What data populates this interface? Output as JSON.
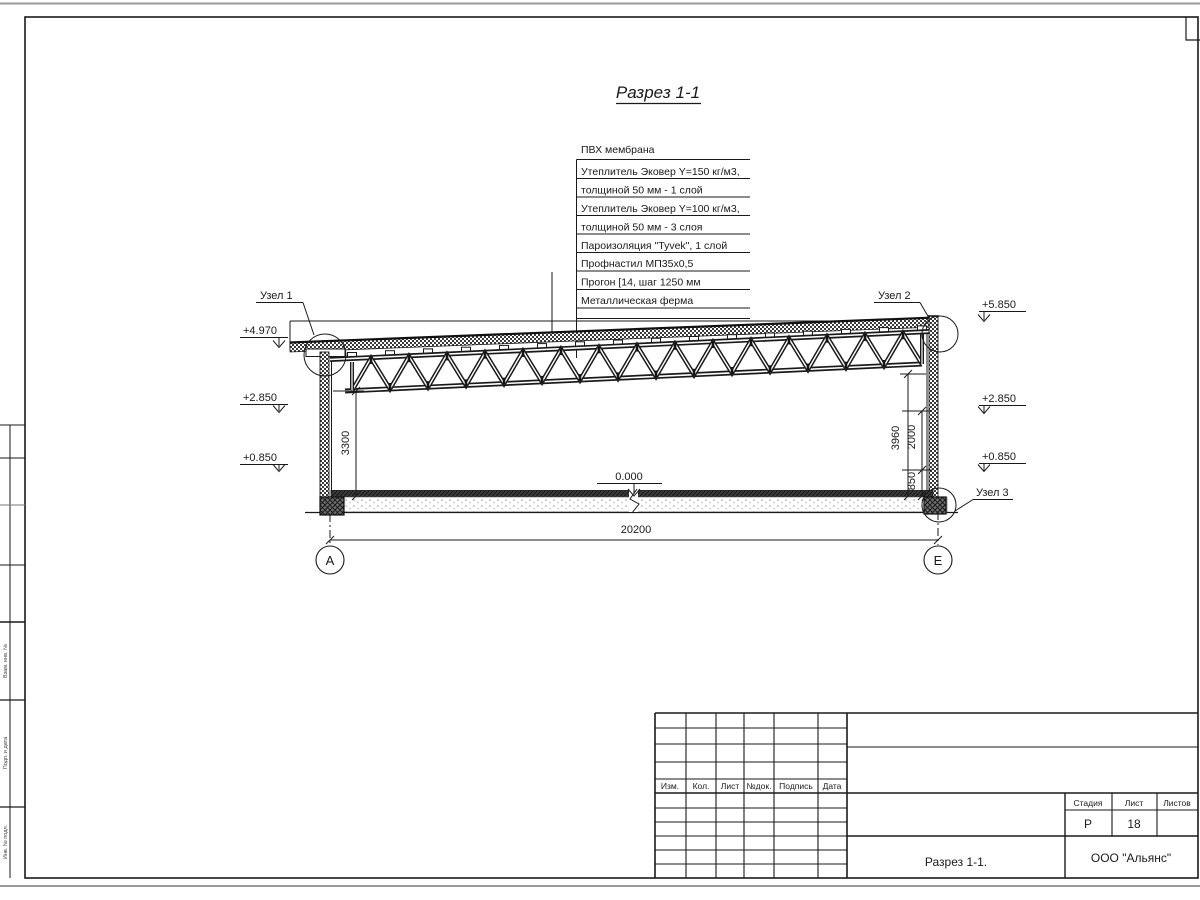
{
  "title": "Разрез 1-1",
  "callouts": {
    "membrane": "ПВХ мембрана",
    "rows": [
      "Утеплитель Эковер Y=150 кг/м3,",
      "толщиной 50 мм - 1 слой",
      "Утеплитель Эковер Y=100 кг/м3,",
      "толщиной 50 мм - 3 слоя",
      "Пароизоляция \"Tyvek\", 1 слой",
      "Профнастил МП35х0,5",
      "Прогон [14, шаг 1250 мм",
      "Металлическая ферма"
    ]
  },
  "nodes": [
    "Узел 1",
    "Узел 2",
    "Узел 3"
  ],
  "elevations": {
    "left": [
      "+4.970",
      "+2.850",
      "+0.850"
    ],
    "right": [
      "+5.850",
      "+2.850",
      "+0.850"
    ],
    "zero": "0.000"
  },
  "dims": {
    "left_height": "3300",
    "right_total": "3960",
    "right_upper": "2000",
    "right_lower": "850",
    "span": "20200"
  },
  "axes": {
    "left": "А",
    "right": "Е"
  },
  "tb": {
    "cols": [
      "Изм.",
      "Кол.",
      "Лист",
      "№док.",
      "Подпись",
      "Дата"
    ],
    "stage_label": "Стадия",
    "sheet_label": "Лист",
    "sheets_label": "Листов",
    "stage": "Р",
    "sheet": "18",
    "name": "Разрез 1-1.",
    "company": "ООО \"Альянс\""
  },
  "side": [
    "Взам. инв. №",
    "Подп. и дата",
    "Инв. № подл."
  ],
  "colors": {
    "line": "#1a1a1a",
    "edge_gray": "#9a9a9a"
  }
}
